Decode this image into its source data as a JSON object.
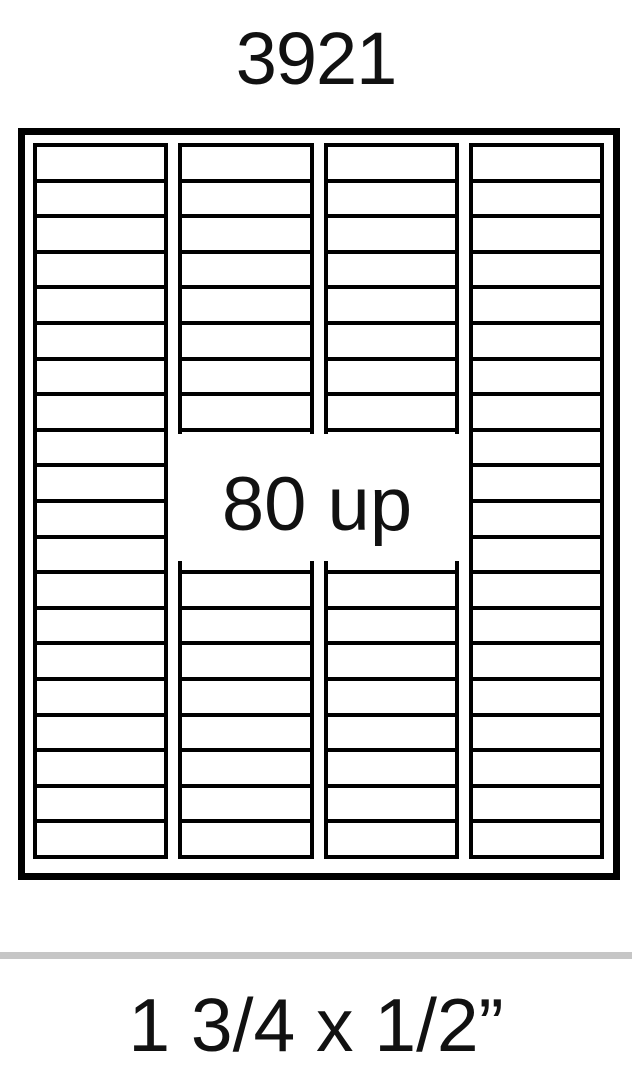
{
  "page": {
    "product_code": "3921",
    "count_label": "80 up",
    "size_label": "1 3/4 x 1/2”",
    "background_color": "#ffffff",
    "text_color": "#111111"
  },
  "sheet": {
    "columns": 4,
    "rows_per_column": 20,
    "total_labels": 80,
    "line_color": "#000000"
  },
  "divider": {
    "color": "#c6c6c6"
  }
}
